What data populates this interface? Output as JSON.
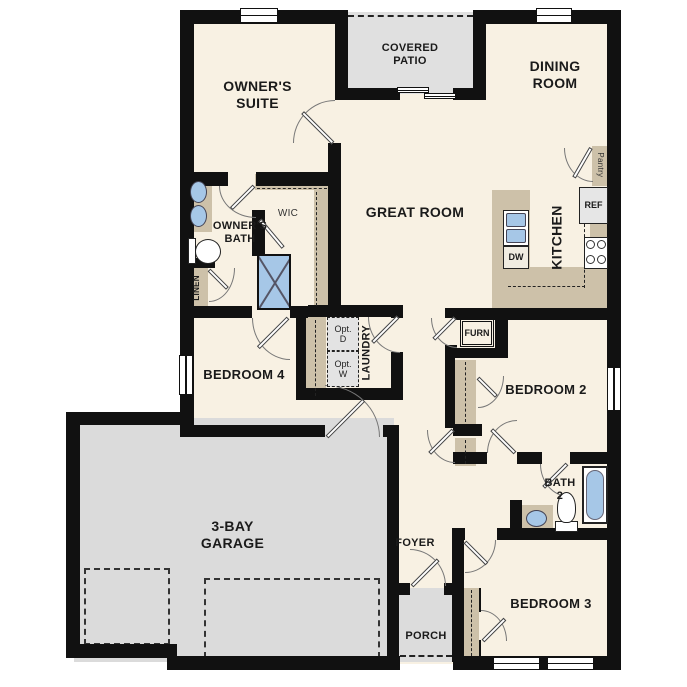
{
  "plan": {
    "title": "single-story floor plan",
    "rooms": {
      "owners_suite": "OWNER'S\nSUITE",
      "covered_patio": "COVERED\nPATIO",
      "dining_room": "DINING\nROOM",
      "great_room": "GREAT ROOM",
      "kitchen": "KITCHEN",
      "owners_bath": "OWNER'S\nBATH",
      "wic": "WIC",
      "linen": "LINEN",
      "pantry": "Pantry",
      "laundry": "LAUNDRY",
      "bedroom_4": "BEDROOM 4",
      "bedroom_2": "BEDROOM 2",
      "bedroom_3": "BEDROOM 3",
      "bath_2": "BATH\n2",
      "garage": "3-BAY\nGARAGE",
      "foyer": "FOYER",
      "porch": "PORCH"
    },
    "appliances": {
      "ref": "REF",
      "dw": "DW",
      "furn": "FURN",
      "opt_dryer": "Opt.\nD",
      "opt_washer": "Opt.\nW"
    },
    "colors": {
      "wall": "#111111",
      "floor": "#f8f1e3",
      "hard_surface": "#dcdcdc",
      "casework": "#cdc1a9",
      "fixture_blue": "#a6c7e7",
      "appliance": "#e6e6e6"
    }
  }
}
